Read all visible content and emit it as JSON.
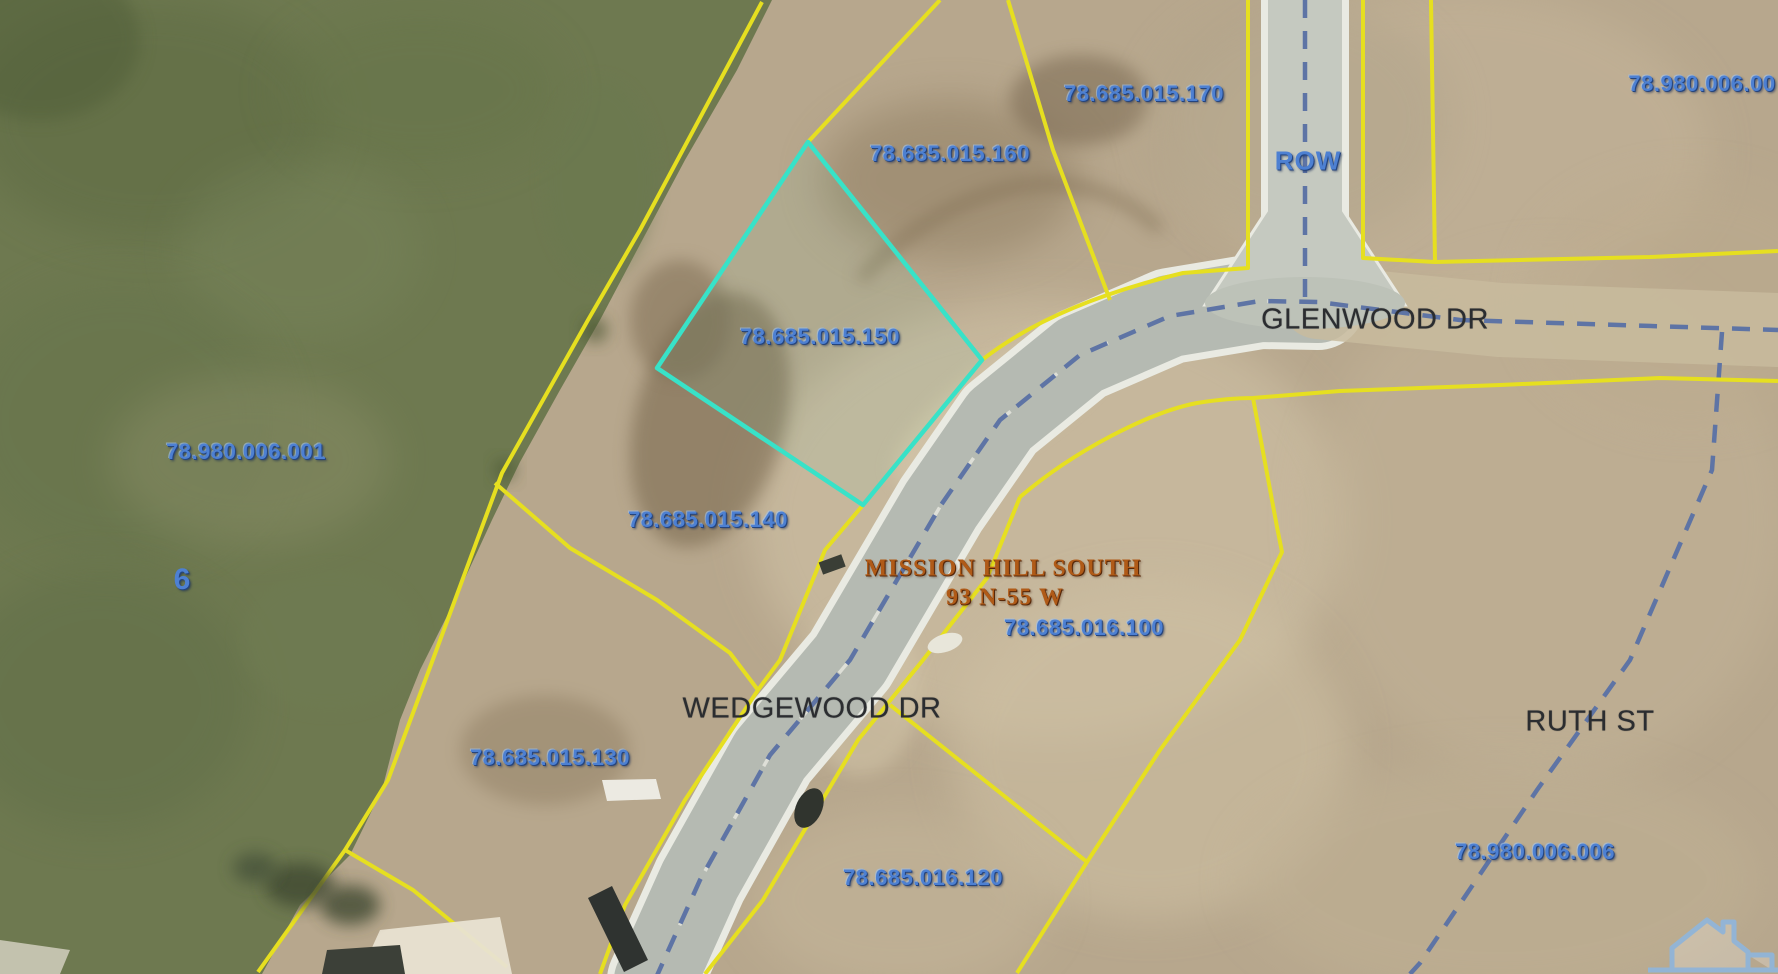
{
  "map": {
    "description": "County GIS aerial parcel map",
    "highlighted_parcel": "78.685.015.150",
    "subdivision": {
      "name": "MISSION HILL SOUTH",
      "township": "93 N-55 W"
    },
    "streets": [
      "GLENWOOD DR",
      "WEDGEWOOD DR",
      "RUTH ST"
    ],
    "section_number": "6",
    "labels": [
      {
        "text": "78.685.015.170",
        "x": 1144,
        "y": 94,
        "type": "parcel"
      },
      {
        "text": "78.685.015.160",
        "x": 950,
        "y": 154,
        "type": "parcel"
      },
      {
        "text": "78.980.006.00",
        "x": 1702,
        "y": 84,
        "type": "parcel",
        "clipped": "right-edge"
      },
      {
        "text": "ROW",
        "x": 1308,
        "y": 161,
        "type": "row"
      },
      {
        "text": "78.685.015.150",
        "x": 820,
        "y": 337,
        "type": "parcel"
      },
      {
        "text": "78.980.006.001",
        "x": 246,
        "y": 452,
        "type": "parcel"
      },
      {
        "text": "78.685.015.140",
        "x": 708,
        "y": 520,
        "type": "parcel"
      },
      {
        "text": "6",
        "x": 182,
        "y": 580,
        "type": "section"
      },
      {
        "text": "MISSION HILL SOUTH",
        "x": 1003,
        "y": 569,
        "type": "subdivision"
      },
      {
        "text": "93 N-55 W",
        "x": 1005,
        "y": 598,
        "type": "subdivision"
      },
      {
        "text": "78.685.016.100",
        "x": 1084,
        "y": 628,
        "type": "parcel"
      },
      {
        "text": "GLENWOOD DR",
        "x": 1375,
        "y": 320,
        "type": "street"
      },
      {
        "text": "WEDGEWOOD DR",
        "x": 812,
        "y": 709,
        "type": "street"
      },
      {
        "text": "RUTH ST",
        "x": 1590,
        "y": 722,
        "type": "street"
      },
      {
        "text": "78.685.015.130",
        "x": 550,
        "y": 758,
        "type": "parcel"
      },
      {
        "text": "78.685.016.120",
        "x": 923,
        "y": 878,
        "type": "parcel"
      },
      {
        "text": "78.980.006.006",
        "x": 1535,
        "y": 852,
        "type": "parcel"
      }
    ],
    "colors": {
      "parcel_line": "#e6df20",
      "highlight_outline": "#38e2c8",
      "parcel_text": "#4d80d2",
      "street_text": "#2b2d30",
      "subdivision_text": "#b05a17",
      "road_centerline": "#5e74a5",
      "pavement": "#b5bab2"
    },
    "watermark": {
      "icon": "house-outline-icon"
    }
  }
}
